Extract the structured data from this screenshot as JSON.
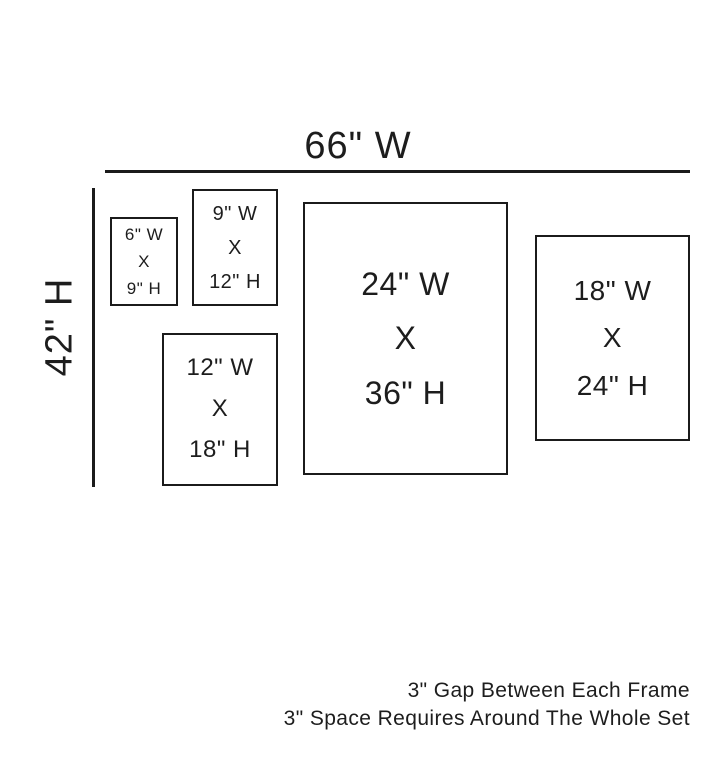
{
  "diagram": {
    "overall": {
      "width_label": "66\" W",
      "height_label": "42\" H"
    },
    "frames": [
      {
        "width_label": "6\" W",
        "separator": "X",
        "height_label": "9\" H"
      },
      {
        "width_label": "9\" W",
        "separator": "X",
        "height_label": "12\" H"
      },
      {
        "width_label": "12\" W",
        "separator": "X",
        "height_label": "18\" H"
      },
      {
        "width_label": "24\" W",
        "separator": "X",
        "height_label": "36\" H"
      },
      {
        "width_label": "18\" W",
        "separator": "X",
        "height_label": "24\" H"
      }
    ],
    "notes": {
      "line1": "3\" Gap Between Each Frame",
      "line2": "3\" Space Requires Around The Whole Set"
    },
    "colors": {
      "line": "#1b1b1b",
      "background": "#ffffff"
    }
  }
}
